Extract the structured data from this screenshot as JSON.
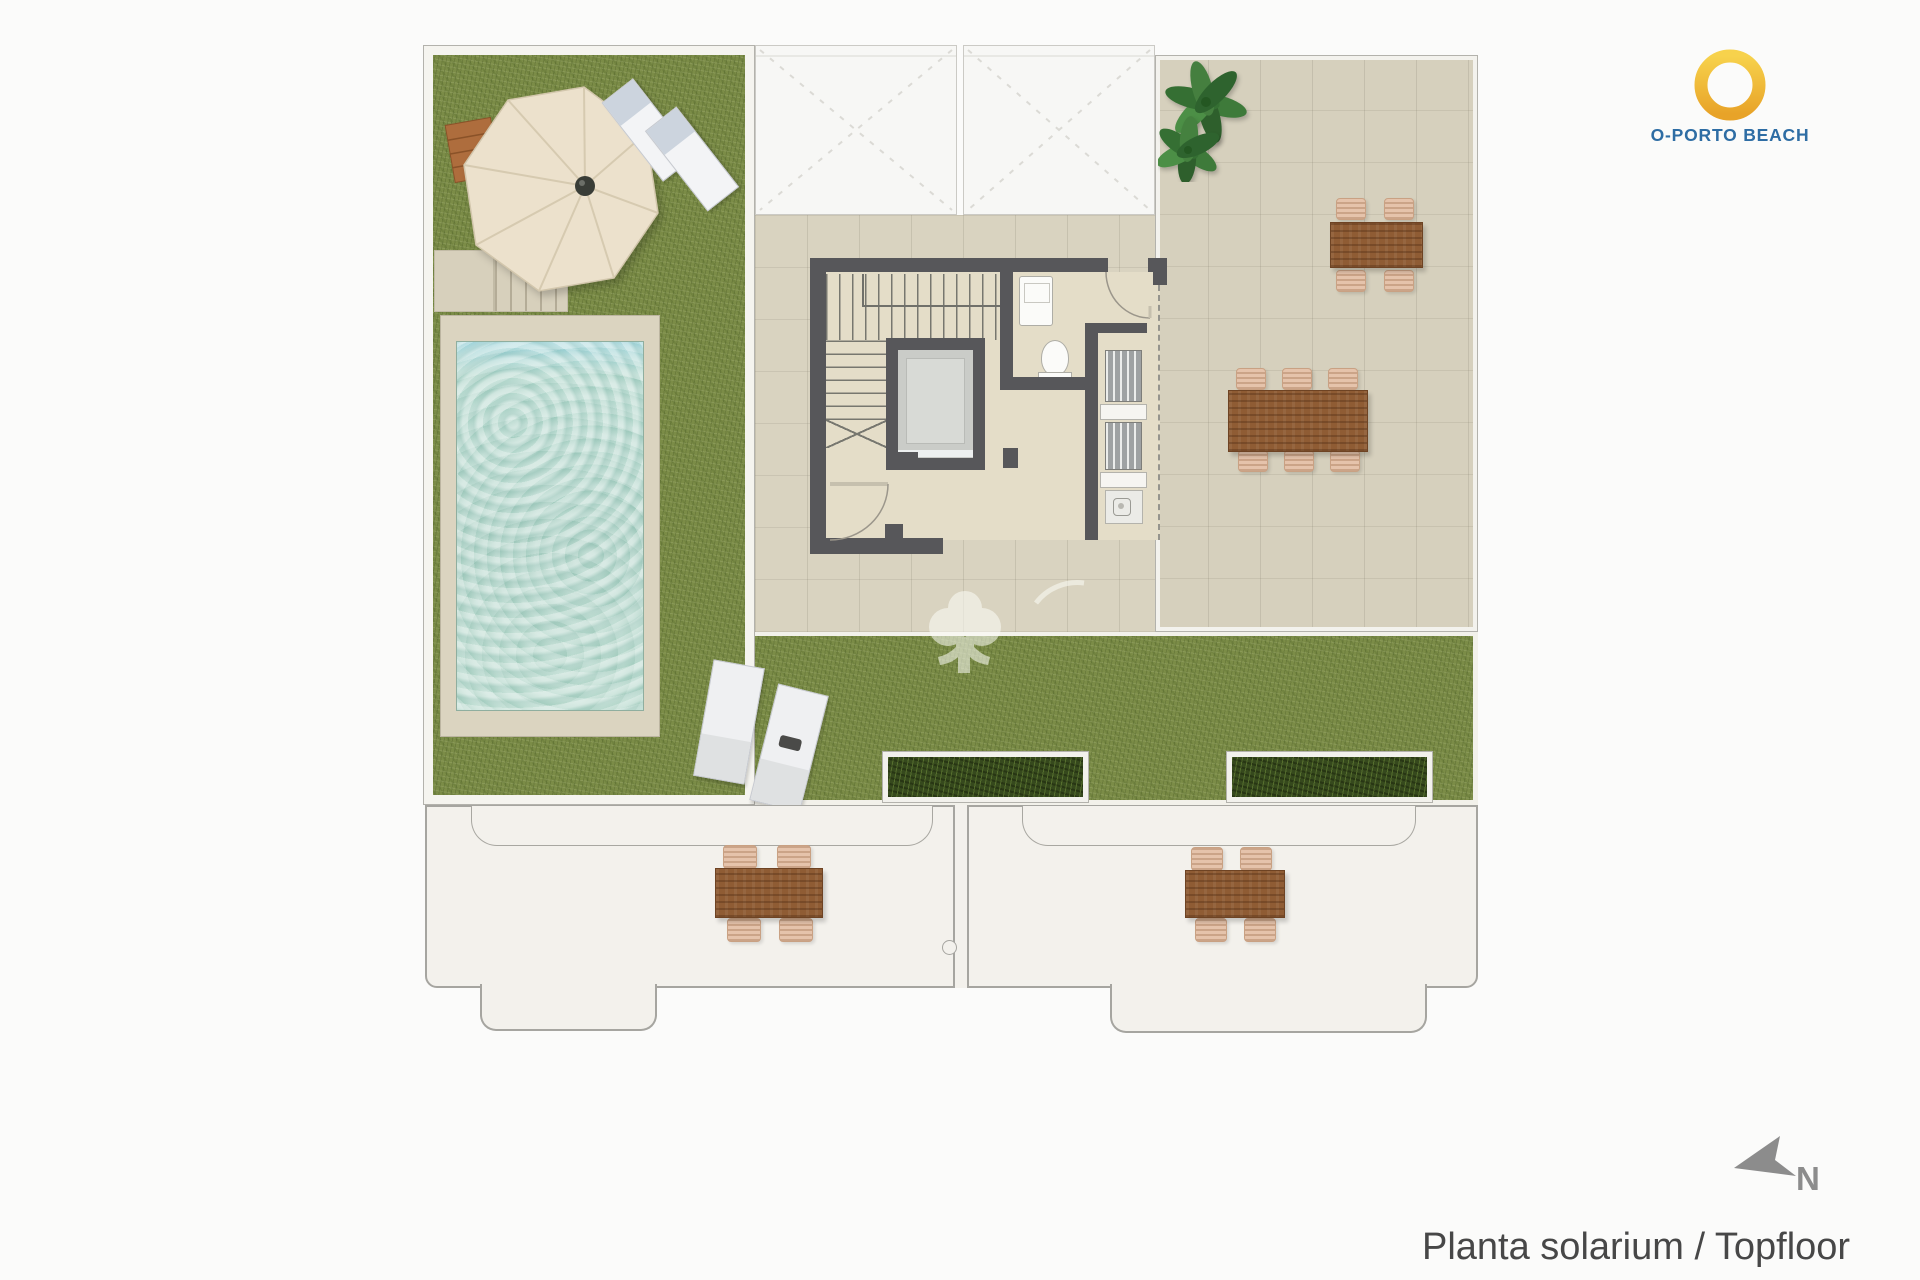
{
  "branding": {
    "logo_text": "O-PORTO BEACH",
    "ring_color": "#F2B737",
    "text_color": "#2E6DA4"
  },
  "caption": {
    "text": "Planta solarium / Topfloor",
    "color": "#474747"
  },
  "compass": {
    "label": "N",
    "color": "#8C8C8C"
  },
  "palette": {
    "background": "#FBFBFA",
    "grass": "#7B8C47",
    "tile": "#D9D3C0",
    "wall": "#57575A",
    "pool_water": "#A2CEC2",
    "pool_deck": "#DBD4C0",
    "balcony": "#F3F1EC",
    "wood_table": "#8F5C34",
    "chair": "#E5C3AB",
    "planter_green": "#36491D",
    "void_white": "#F7F7F5"
  }
}
